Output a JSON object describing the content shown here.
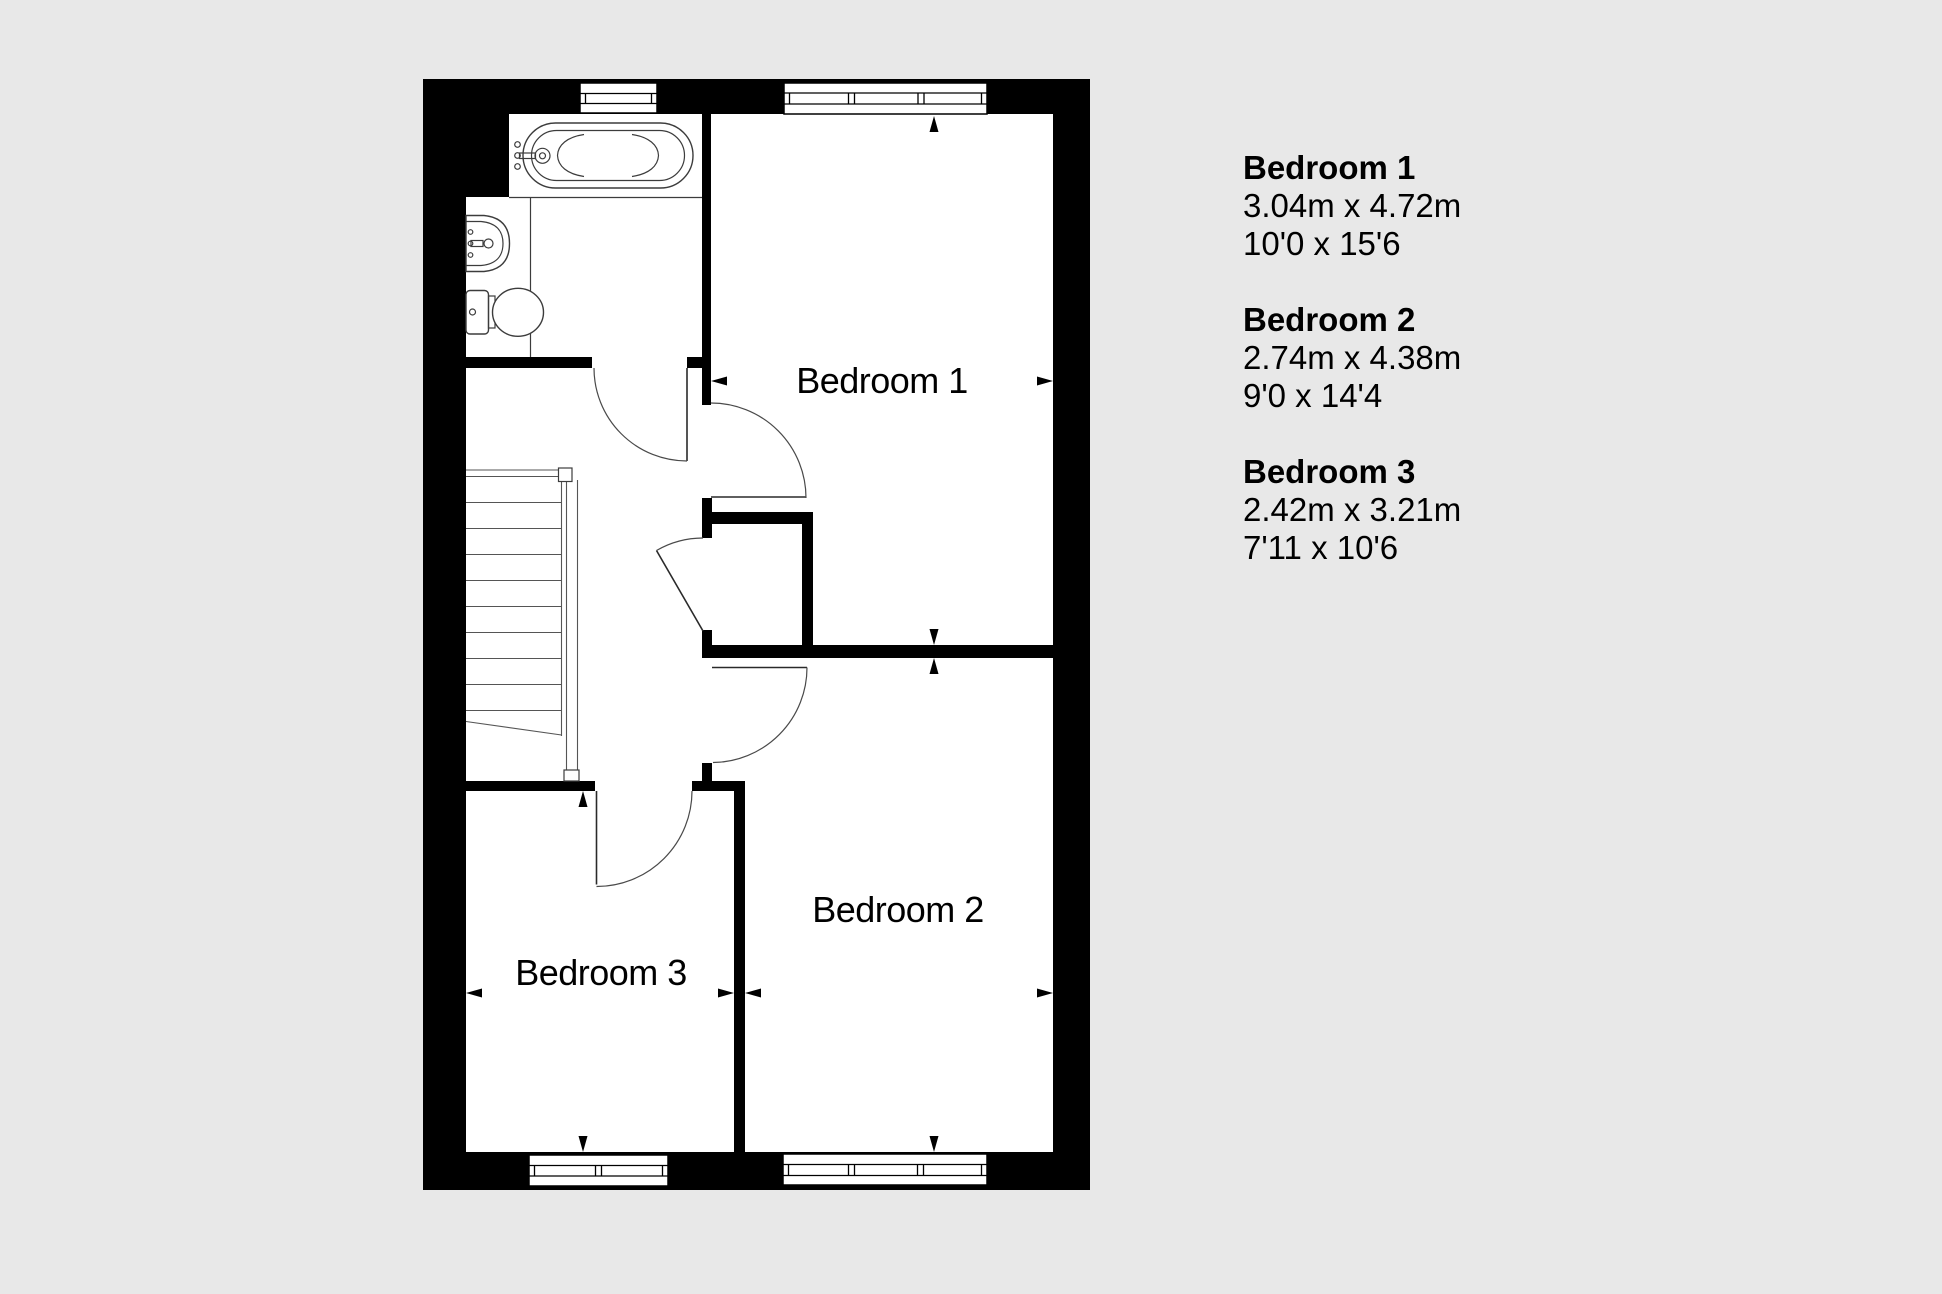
{
  "floorplan": {
    "rooms": {
      "bedroom1": {
        "label": "Bedroom 1"
      },
      "bedroom2": {
        "label": "Bedroom 2"
      },
      "bedroom3": {
        "label": "Bedroom 3"
      }
    },
    "features": [
      "bathtub",
      "sink",
      "toilet",
      "staircase",
      "windows",
      "doors",
      "built-in-cupboard"
    ]
  },
  "legend": {
    "items": [
      {
        "name": "Bedroom 1",
        "metric": "3.04m x 4.72m",
        "imperial": "10'0 x 15'6"
      },
      {
        "name": "Bedroom 2",
        "metric": "2.74m x 4.38m",
        "imperial": "9'0 x 14'4"
      },
      {
        "name": "Bedroom 3",
        "metric": "2.42m x 3.21m",
        "imperial": "7'11 x 10'6"
      }
    ]
  },
  "colors": {
    "background": "#e8e8e8",
    "walls": "#000000",
    "floor": "#ffffff",
    "text": "#000000"
  }
}
